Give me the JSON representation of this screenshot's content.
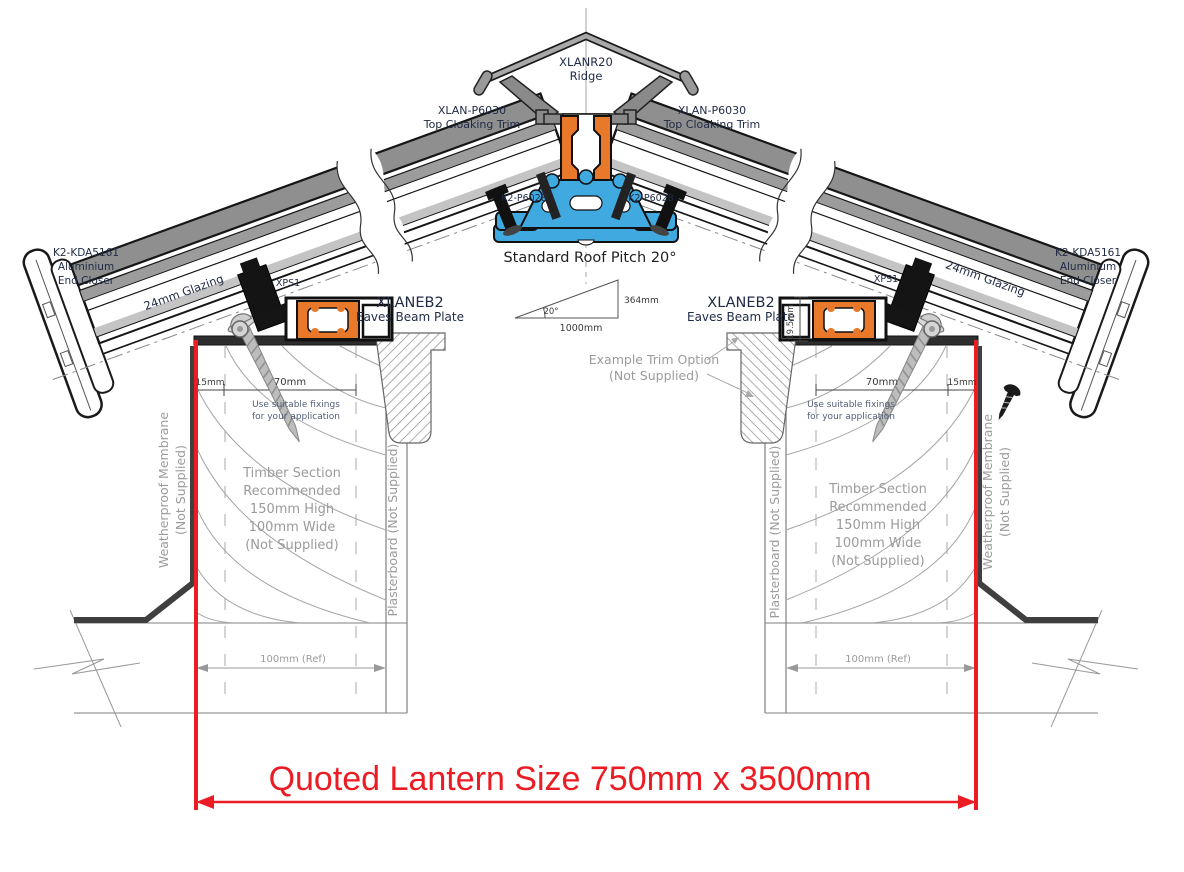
{
  "colors": {
    "red": "#EC1C24",
    "blue": "#3FA9E0",
    "orange": "#E8782A",
    "trimgray": "#8F8F8F",
    "plate": "#2E2E2E"
  },
  "parts": {
    "ridge_code": "XLANR20",
    "ridge_name": "Ridge",
    "cloaking_code": "XLAN-P6030",
    "cloaking_name": "Top Cloaking Trim",
    "ridge_fixing": "K2-P6028",
    "end_closer_code": "K2-KDA5161",
    "end_closer_l2": "Aluminium",
    "end_closer_l3": "End Closer",
    "glazing": "24mm Glazing",
    "xps": "XPS1",
    "eaves_code": "XLANEB2",
    "eaves_name": "Eaves Beam Plate"
  },
  "pitch": {
    "title": "Standard Roof Pitch 20°",
    "angle": "20°",
    "run": "1000mm",
    "rise": "364mm"
  },
  "dimensions": {
    "edge": "15mm",
    "fixing_zone": "70mm",
    "plate_height": "19.5mm",
    "kerb_ref": "100mm (Ref)"
  },
  "notes": {
    "fixings_l1": "Use suitable fixings",
    "fixings_l2": "for your application",
    "trim_option_l1": "Example  Trim Option",
    "trim_option_l2": "(Not Supplied)",
    "timber_l1": "Timber Section",
    "timber_l2": "Recommended",
    "timber_l3": "150mm High",
    "timber_l4": "100mm Wide",
    "timber_l5": "(Not Supplied)",
    "membrane_l1": "Weatherproof Membrane",
    "membrane_l2": "(Not Supplied)",
    "plasterboard": "Plasterboard (Not Supplied)"
  },
  "footer": {
    "quoted_size": "Quoted Lantern Size 750mm x 3500mm"
  }
}
